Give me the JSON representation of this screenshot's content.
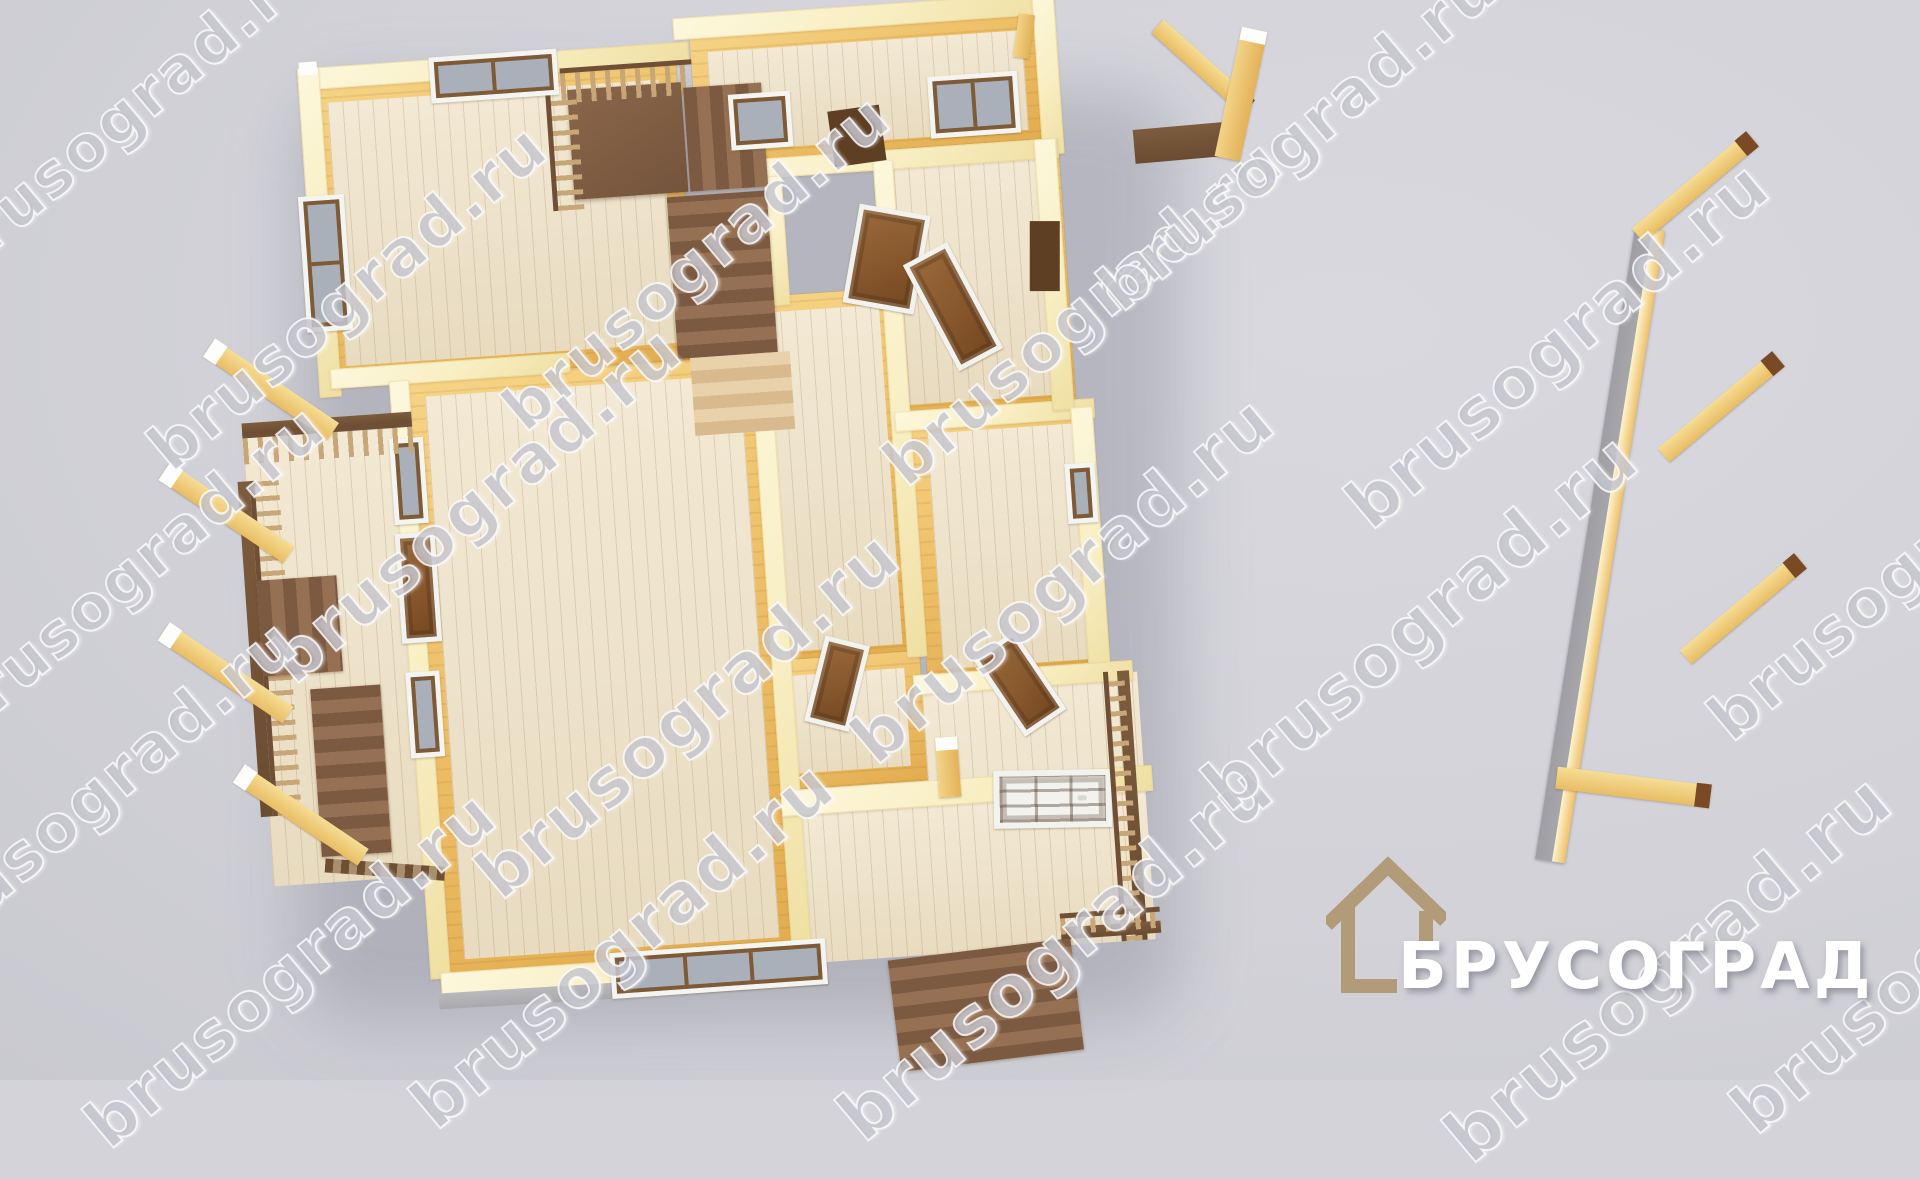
{
  "watermark": {
    "text": "brusograd.ru"
  },
  "logo": {
    "name": "БРУСОГРАД",
    "icon": "house-outline-icon",
    "icon_color": "#b29b78",
    "text_color": "#ffffff"
  },
  "palette": {
    "background": "#d3d3d9",
    "wall_top_cream": "#f8eec2",
    "wall_face_wood": "#eec069",
    "floor_plank": "#efe2c6",
    "door_brown": "#85552c",
    "door_frame_white": "#f2f2ee",
    "window_glass_gray": "#aab0ba",
    "window_sash_brown": "#7e5a36",
    "stairs_brown": "#7c5941",
    "stairs_light": "#d9ba8e",
    "railing_brown": "#6f5036",
    "support_beam_yellow": "#e9bd63",
    "beam_cap_white": "#fdfdfb",
    "beam_tip_brown": "#7a4a26",
    "detached_wall_gray": "#a4a4a9",
    "watermark_gray": "#c8c9d2"
  },
  "scene": {
    "description": "3D top-down render of the first floor of a timber (brus) house",
    "elements": [
      "living-room-top-left",
      "great-room-center",
      "hallway",
      "room-top-right",
      "room-mid-right",
      "room-low-right",
      "small-room-bottom",
      "staircase-with-landing",
      "left-porch-with-railing",
      "bottom-right-terrace",
      "entrance-door",
      "porch-steps",
      "terrace-steps",
      "detached-gray-wall-panel",
      "roof-support-beams"
    ]
  }
}
